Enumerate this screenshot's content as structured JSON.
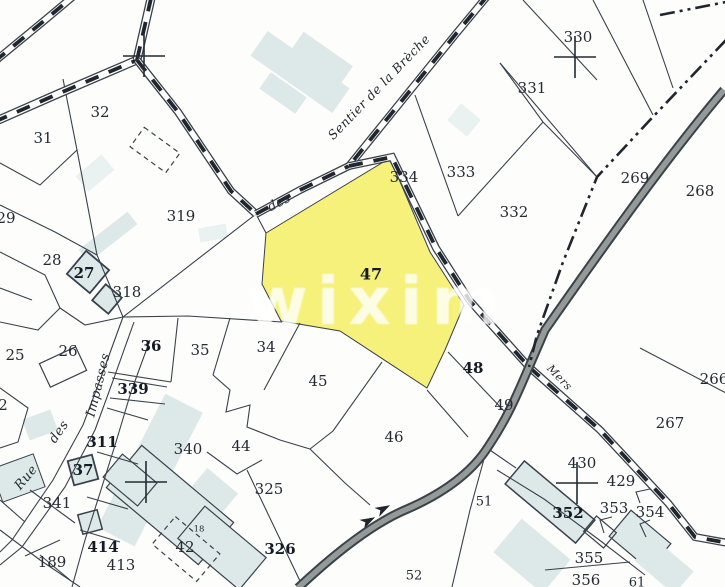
{
  "map": {
    "type": "cadastral-parcel-map",
    "watermark": {
      "text": "wixim",
      "x": 378,
      "y": 324,
      "size": 66,
      "color": "rgba(255,255,255,0.80)",
      "letter_spacing": 9
    },
    "colors": {
      "paper": "#fdfdfb",
      "line": "#39414c",
      "ink": "#242b34",
      "dash_ink": "#20262e",
      "label": "#242b35",
      "label_bold": "#141b25",
      "highlight_yellow": "#f5f17b",
      "building_fill": "#dde9e8",
      "building_fill_light": "#eaf2f1",
      "route_fill": "#939a97",
      "route_casing": "#3a424c"
    },
    "highlight_parcel": {
      "number": "47",
      "points": "390,158 430,252 464,305 445,350 427,388 340,331 281,321 262,284 266,233"
    },
    "street_names": [
      {
        "text": "Sentier de la Brèche",
        "x": 382,
        "y": 90,
        "rot": -46,
        "size": 12.5
      },
      {
        "text": "des",
        "x": 281,
        "y": 206,
        "rot": -27,
        "size": 13
      },
      {
        "text": "Impasses",
        "x": 102,
        "y": 386,
        "rot": -76,
        "size": 13
      },
      {
        "text": "des",
        "x": 62,
        "y": 434,
        "rot": -55,
        "size": 13
      },
      {
        "text": "Rue",
        "x": 29,
        "y": 480,
        "rot": -50,
        "size": 13
      },
      {
        "text": "Mers",
        "x": 557,
        "y": 380,
        "rot": 46,
        "size": 11
      }
    ],
    "parcel_labels": [
      {
        "text": "32",
        "x": 100,
        "y": 113
      },
      {
        "text": "31",
        "x": 43,
        "y": 139
      },
      {
        "text": "29",
        "x": 6,
        "y": 219
      },
      {
        "text": "28",
        "x": 52,
        "y": 261
      },
      {
        "text": "27",
        "x": 84,
        "y": 274,
        "bold": true
      },
      {
        "text": "318",
        "x": 127,
        "y": 293
      },
      {
        "text": "319",
        "x": 181,
        "y": 217
      },
      {
        "text": "25",
        "x": 15,
        "y": 356
      },
      {
        "text": "26",
        "x": 68,
        "y": 352
      },
      {
        "text": "36",
        "x": 151,
        "y": 347,
        "bold": true
      },
      {
        "text": "35",
        "x": 200,
        "y": 351
      },
      {
        "text": "34",
        "x": 266,
        "y": 348
      },
      {
        "text": "45",
        "x": 318,
        "y": 382
      },
      {
        "text": "44",
        "x": 241,
        "y": 447
      },
      {
        "text": "46",
        "x": 394,
        "y": 438
      },
      {
        "text": "340",
        "x": 188,
        "y": 450
      },
      {
        "text": "339",
        "x": 133,
        "y": 390,
        "bold": true
      },
      {
        "text": "311",
        "x": 102,
        "y": 443,
        "bold": true
      },
      {
        "text": "37",
        "x": 83,
        "y": 471,
        "bold": true
      },
      {
        "text": "341",
        "x": 57,
        "y": 504
      },
      {
        "text": "189",
        "x": 52,
        "y": 563
      },
      {
        "text": "414",
        "x": 103,
        "y": 548,
        "bold": true
      },
      {
        "text": "413",
        "x": 121,
        "y": 566
      },
      {
        "text": "42",
        "x": 185,
        "y": 548
      },
      {
        "text": "18",
        "x": 199,
        "y": 529,
        "size": 8.5
      },
      {
        "text": "325",
        "x": 269,
        "y": 490
      },
      {
        "text": "326",
        "x": 280,
        "y": 550,
        "bold": true
      },
      {
        "text": "2",
        "x": 3,
        "y": 406
      },
      {
        "text": "47",
        "x": 371,
        "y": 275,
        "bold": true,
        "size": 16
      },
      {
        "text": "48",
        "x": 473,
        "y": 369,
        "bold": true
      },
      {
        "text": "49",
        "x": 504,
        "y": 406
      },
      {
        "text": "51",
        "x": 484,
        "y": 502,
        "size": 13
      },
      {
        "text": "52",
        "x": 414,
        "y": 576,
        "size": 13
      },
      {
        "text": "334",
        "x": 404,
        "y": 178
      },
      {
        "text": "333",
        "x": 461,
        "y": 173
      },
      {
        "text": "332",
        "x": 514,
        "y": 213
      },
      {
        "text": "331",
        "x": 532,
        "y": 89
      },
      {
        "text": "330",
        "x": 578,
        "y": 38
      },
      {
        "text": "269",
        "x": 635,
        "y": 179
      },
      {
        "text": "268",
        "x": 700,
        "y": 192
      },
      {
        "text": "267",
        "x": 670,
        "y": 424
      },
      {
        "text": "266",
        "x": 714,
        "y": 380
      },
      {
        "text": "430",
        "x": 582,
        "y": 464
      },
      {
        "text": "429",
        "x": 621,
        "y": 482
      },
      {
        "text": "352",
        "x": 568,
        "y": 514,
        "bold": true
      },
      {
        "text": "353",
        "x": 614,
        "y": 509
      },
      {
        "text": "354",
        "x": 650,
        "y": 513
      },
      {
        "text": "355",
        "x": 589,
        "y": 559
      },
      {
        "text": "356",
        "x": 586,
        "y": 581
      },
      {
        "text": "61",
        "x": 637,
        "y": 583,
        "size": 13
      }
    ],
    "survey_crosses": [
      {
        "x": 144,
        "y": 56
      },
      {
        "x": 575,
        "y": 57
      },
      {
        "x": 146,
        "y": 482
      },
      {
        "x": 577,
        "y": 483
      }
    ],
    "roads": [
      {
        "pts": "-6,122 60,93 137,60",
        "w": 9
      },
      {
        "pts": "137,60 152,-6",
        "w": 9
      },
      {
        "pts": "-6,62 45,20 76,-6",
        "w": 8
      },
      {
        "pts": "137,60 178,112 231,191 256,214",
        "w": 8
      },
      {
        "pts": "256,214 300,190 349,166",
        "w": 8
      },
      {
        "pts": "489,-6 455,35 349,166",
        "w": 8
      },
      {
        "pts": "349,166 392,157 436,248 470,301 529,367",
        "w": 8
      },
      {
        "pts": "529,367 600,430 668,503 695,537 728,543",
        "w": 8
      }
    ],
    "route": {
      "d": "M 724,90 C 660,165 580,280 545,330 L 529,367 C 515,400 506,420 488,447 C 470,475 440,495 405,510 C 370,525 330,558 298,588"
    },
    "boundary_segments": [
      "726,40 650,120 597,177 563,262 537,335 529,367",
      "660,15 726,2"
    ],
    "parcel_lines": [
      "63,79 77,150",
      "77,150 40,185 0,163",
      "77,150 97,255 123,317",
      "0,205 55,232 97,255",
      "0,252 45,275 60,308",
      "60,308 38,330 0,322",
      "60,308 85,325 123,317",
      "0,288 32,300",
      "123,317 188,316 282,322",
      "256,214 123,317",
      "266,233 257,216",
      "178,318 171,382",
      "230,318 213,375",
      "300,323 264,390",
      "171,382 108,372",
      "112,378 167,387",
      "110,398 165,404",
      "213,375 230,390 226,412 250,405 247,427 280,440 310,449",
      "382,362 333,431 310,449",
      "310,449 345,483 370,505",
      "207,452 237,474 262,460",
      "247,470 300,581",
      "123,317 103,372 83,425 53,480 12,540 0,552",
      "134,322 114,378 95,430 65,487 22,547 0,565",
      "150,340 131,392 116,442 100,493 85,540 72,587",
      "107,408 148,420",
      "97,452 138,464",
      "87,497 128,509",
      "80,530 120,542",
      "30,490 75,523",
      "0,530 40,560 80,587",
      "25,556 60,540",
      "0,388 28,408 18,442 0,448",
      "448,352 505,412",
      "427,390 468,437",
      "640,348 726,393",
      "415,95 458,216",
      "458,216 543,122",
      "543,122 500,63",
      "500,63 597,177",
      "523,0 597,80",
      "593,0 653,115",
      "643,0 673,88",
      "543,122 597,177",
      "487,448 470,510 452,587",
      "487,448 516,468",
      "497,470 544,499 598,539 645,575",
      "545,570 630,562",
      "650,489 636,492 640,503",
      "612,517 600,520 604,533",
      "650,520 640,524 646,537",
      "0,500 25,522",
      "40,555 70,580"
    ],
    "buildings": [
      {
        "cx": 300,
        "cy": 72,
        "w": 100,
        "h": 30,
        "rot": 35,
        "fill": "light"
      },
      {
        "cx": 322,
        "cy": 58,
        "w": 60,
        "h": 22,
        "rot": 35,
        "fill": "light"
      },
      {
        "cx": 283,
        "cy": 93,
        "w": 44,
        "h": 20,
        "rot": 35,
        "fill": "light"
      },
      {
        "cx": 464,
        "cy": 120,
        "w": 26,
        "h": 22,
        "rot": 40,
        "fill": "lighter"
      },
      {
        "cx": 108,
        "cy": 237,
        "w": 62,
        "h": 16,
        "rot": -38,
        "fill": "light"
      },
      {
        "cx": 95,
        "cy": 173,
        "w": 34,
        "h": 20,
        "rot": -40,
        "fill": "lighter"
      },
      {
        "cx": 213,
        "cy": 233,
        "w": 28,
        "h": 14,
        "rot": -10,
        "fill": "lighter"
      },
      {
        "cx": 88,
        "cy": 272,
        "w": 30,
        "h": 30,
        "rot": 40,
        "fill": "light",
        "stroke": 1.8
      },
      {
        "cx": 107,
        "cy": 299,
        "w": 21,
        "h": 21,
        "rot": 40,
        "fill": "light",
        "stroke": 1.8
      },
      {
        "cx": 63,
        "cy": 367,
        "w": 40,
        "h": 26,
        "rot": -25,
        "fill": "none",
        "stroke": 1.2
      },
      {
        "cx": 150,
        "cy": 470,
        "w": 150,
        "h": 42,
        "rot": -63,
        "fill": "light"
      },
      {
        "cx": 83,
        "cy": 470,
        "w": 25,
        "h": 25,
        "rot": -15,
        "fill": "light",
        "stroke": 1.8
      },
      {
        "cx": 170,
        "cy": 505,
        "w": 120,
        "h": 55,
        "rot": 40,
        "fill": "light",
        "stroke": 1.2
      },
      {
        "cx": 222,
        "cy": 548,
        "w": 80,
        "h": 42,
        "rot": 40,
        "fill": "light",
        "stroke": 1.2
      },
      {
        "cx": 130,
        "cy": 480,
        "w": 45,
        "h": 30,
        "rot": 40,
        "fill": "light",
        "stroke": 1.2
      },
      {
        "cx": 215,
        "cy": 490,
        "w": 40,
        "h": 24,
        "rot": 40,
        "fill": "light"
      },
      {
        "cx": 550,
        "cy": 502,
        "w": 92,
        "h": 30,
        "rot": 40,
        "fill": "light",
        "stroke": 1.5
      },
      {
        "cx": 640,
        "cy": 540,
        "w": 52,
        "h": 34,
        "rot": 40,
        "fill": "light",
        "stroke": 1.2
      },
      {
        "cx": 532,
        "cy": 556,
        "w": 64,
        "h": 44,
        "rot": 40,
        "fill": "light"
      },
      {
        "cx": 664,
        "cy": 566,
        "w": 52,
        "h": 30,
        "rot": 40,
        "fill": "light"
      },
      {
        "cx": 600,
        "cy": 532,
        "w": 26,
        "h": 20,
        "rot": 40,
        "fill": "none",
        "stroke": 1.2
      },
      {
        "cx": 90,
        "cy": 522,
        "w": 20,
        "h": 20,
        "rot": -15,
        "fill": "light",
        "stroke": 1.5
      },
      {
        "cx": 18,
        "cy": 478,
        "w": 45,
        "h": 35,
        "rot": -20,
        "fill": "light",
        "stroke": 1
      },
      {
        "cx": 40,
        "cy": 425,
        "w": 30,
        "h": 22,
        "rot": -20,
        "fill": "light"
      }
    ],
    "dashed_shapes": [
      {
        "cx": 155,
        "cy": 150,
        "w": 44,
        "h": 24,
        "rot": 36
      },
      {
        "cx": 186,
        "cy": 549,
        "w": 58,
        "h": 36,
        "rot": 40
      }
    ],
    "arrows": [
      {
        "x": 383,
        "y": 509,
        "rot": -28
      },
      {
        "x": 368,
        "y": 521,
        "rot": -28
      }
    ]
  }
}
